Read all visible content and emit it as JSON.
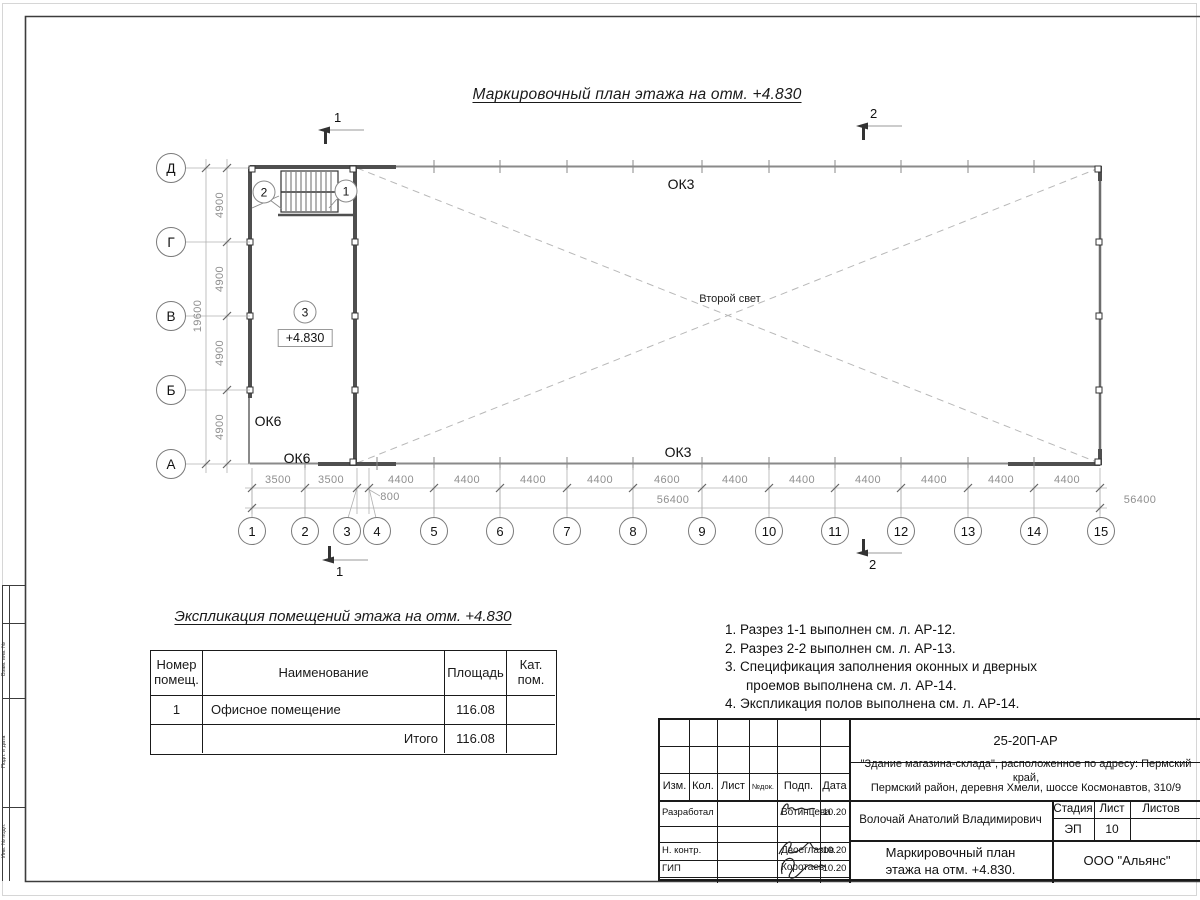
{
  "sheet": {
    "plan_title": "Маркировочный план этажа на отм. +4.830",
    "colors": {
      "frame": "#3c3c3c",
      "wall": "#4f4f4f",
      "dim_text": "#8f8f8f",
      "dashed": "#b8b8b8"
    }
  },
  "plan": {
    "axes_left": [
      "Д",
      "Г",
      "В",
      "Б",
      "А"
    ],
    "axes_bottom": [
      "1",
      "2",
      "3",
      "4",
      "5",
      "6",
      "7",
      "8",
      "9",
      "10",
      "11",
      "12",
      "13",
      "14",
      "15"
    ],
    "dims_left": [
      "4900",
      "4900",
      "4900",
      "4900"
    ],
    "dims_left_total": "19600",
    "dims_bottom": [
      "3500",
      "3500",
      "4400",
      "4400",
      "4400",
      "4400",
      "4600",
      "4400",
      "4400",
      "4400",
      "4400",
      "4400",
      "4400"
    ],
    "dim_offset": "800",
    "dims_bottom_total": "56400",
    "labels": {
      "ok3": "ОК3",
      "ok6": "ОК6",
      "second_light": "Второй свет",
      "elevation": "+4.830",
      "room_mark": "3",
      "stair_mark_1": "1",
      "stair_mark_2": "2"
    },
    "section_marks": {
      "s1": "1",
      "s2": "2"
    }
  },
  "explication": {
    "title": "Экспликация помещений этажа на отм. +4.830",
    "headers": {
      "num": "Номер помещ.",
      "name": "Наименование",
      "area": "Площадь",
      "cat": "Кат. пом."
    },
    "rows": [
      {
        "num": "1",
        "name": "Офисное помещение",
        "area": "116.08",
        "cat": ""
      }
    ],
    "total_label": "Итого",
    "total_area": "116.08"
  },
  "notes": {
    "lines": [
      {
        "text": "1. Разрез 1-1 выполнен см. л. АР-12."
      },
      {
        "text": "2. Разрез 2-2 выполнен см. л. АР-13."
      },
      {
        "text": "3. Спецификация заполнения оконных и дверных"
      },
      {
        "text": "проемов выполнена см. л. АР-14."
      },
      {
        "text": "4. Экспликация полов выполнена см. л. АР-14."
      }
    ]
  },
  "title_block": {
    "doc_number": "25-20П-АР",
    "project_line1": "\"Здание магазина-склада\", расположенное по адресу: Пермский край,",
    "project_line2": "Пермский район, деревня Хмели, шоссе Космонавтов, 310/9",
    "rev_headers": [
      "Изм.",
      "Кол.",
      "Лист",
      "№док.",
      "Подп.",
      "Дата"
    ],
    "roles": [
      {
        "role": "Разработал",
        "name": "Вотинцева",
        "date": "10.20"
      },
      {
        "role": "Н. контр.",
        "name": "Двоеглазов",
        "date": "10.20"
      },
      {
        "role": "ГИП",
        "name": "Коротаев",
        "date": "10.20"
      }
    ],
    "approver": "Волочай Анатолий Владимирович",
    "stage_headers": [
      "Стадия",
      "Лист",
      "Листов"
    ],
    "stage": "ЭП",
    "sheet_number": "10",
    "sheets_total": "",
    "sheet_title_line1": "Маркировочный план",
    "sheet_title_line2": "этажа на отм. +4.830.",
    "organization": "ООО \"Альянс\""
  },
  "side_stamp": {
    "labels": [
      "Взам. инв. №",
      "Подп. и дата",
      "Инв. № подл."
    ]
  }
}
